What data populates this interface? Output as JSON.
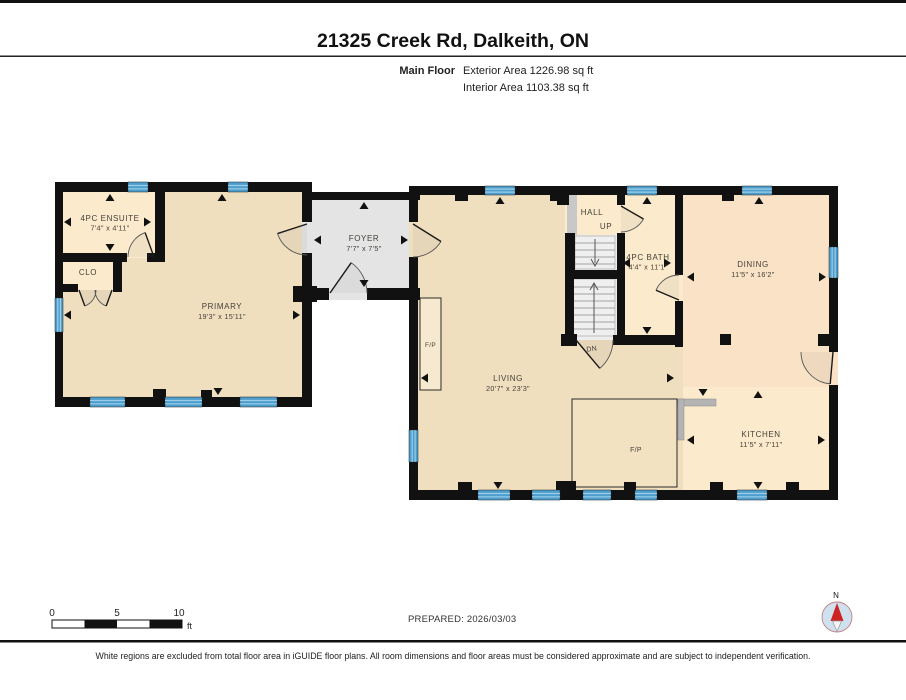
{
  "header": {
    "title": "21325 Creek Rd, Dalkeith, ON",
    "floor_label": "Main Floor",
    "exterior_area": "Exterior Area 1226.98 sq ft",
    "interior_area": "Interior Area 1103.38 sq ft"
  },
  "rooms": {
    "ensuite": {
      "name": "4PC ENSUITE",
      "dims": "7'4\" x 4'11\""
    },
    "closet": {
      "name": "CLO"
    },
    "primary": {
      "name": "PRIMARY",
      "dims": "19'3\" x 15'11\""
    },
    "foyer": {
      "name": "FOYER",
      "dims": "7'7\" x 7'5\""
    },
    "hall": {
      "name": "HALL"
    },
    "bath": {
      "name": "4PC BATH",
      "dims": "4'4\" x 11'1\""
    },
    "dining": {
      "name": "DINING",
      "dims": "11'5\" x 16'2\""
    },
    "living": {
      "name": "LIVING",
      "dims": "20'7\" x 23'3\""
    },
    "kitchen": {
      "name": "KITCHEN",
      "dims": "11'5\" x 7'11\""
    }
  },
  "annotations": {
    "up": "UP",
    "down": "DN",
    "fireplace": "F/P"
  },
  "compass": {
    "north_label": "N"
  },
  "scale_bar": {
    "ticks": [
      "0",
      "5",
      "10"
    ],
    "unit": "ft"
  },
  "footer": {
    "prepared": "PREPARED: 2026/03/03",
    "disclaimer": "White regions are excluded from total floor area in iGUIDE floor plans. All room dimensions and floor areas must be considered approximate and are subject to independent verification."
  },
  "colors": {
    "wall": "#111111",
    "floor_tan": "#f0dfbf",
    "floor_cream": "#fbeacb",
    "floor_peach": "#f9e2c6",
    "floor_foyer": "#e4e4e4",
    "stair": "#ededed",
    "window_blue": "#4e9ecd",
    "window_stripe": "#9ccde8",
    "counter_gray": "#b4b4b4",
    "compass_red": "#cc2222",
    "compass_blue": "#cfe0ef"
  }
}
